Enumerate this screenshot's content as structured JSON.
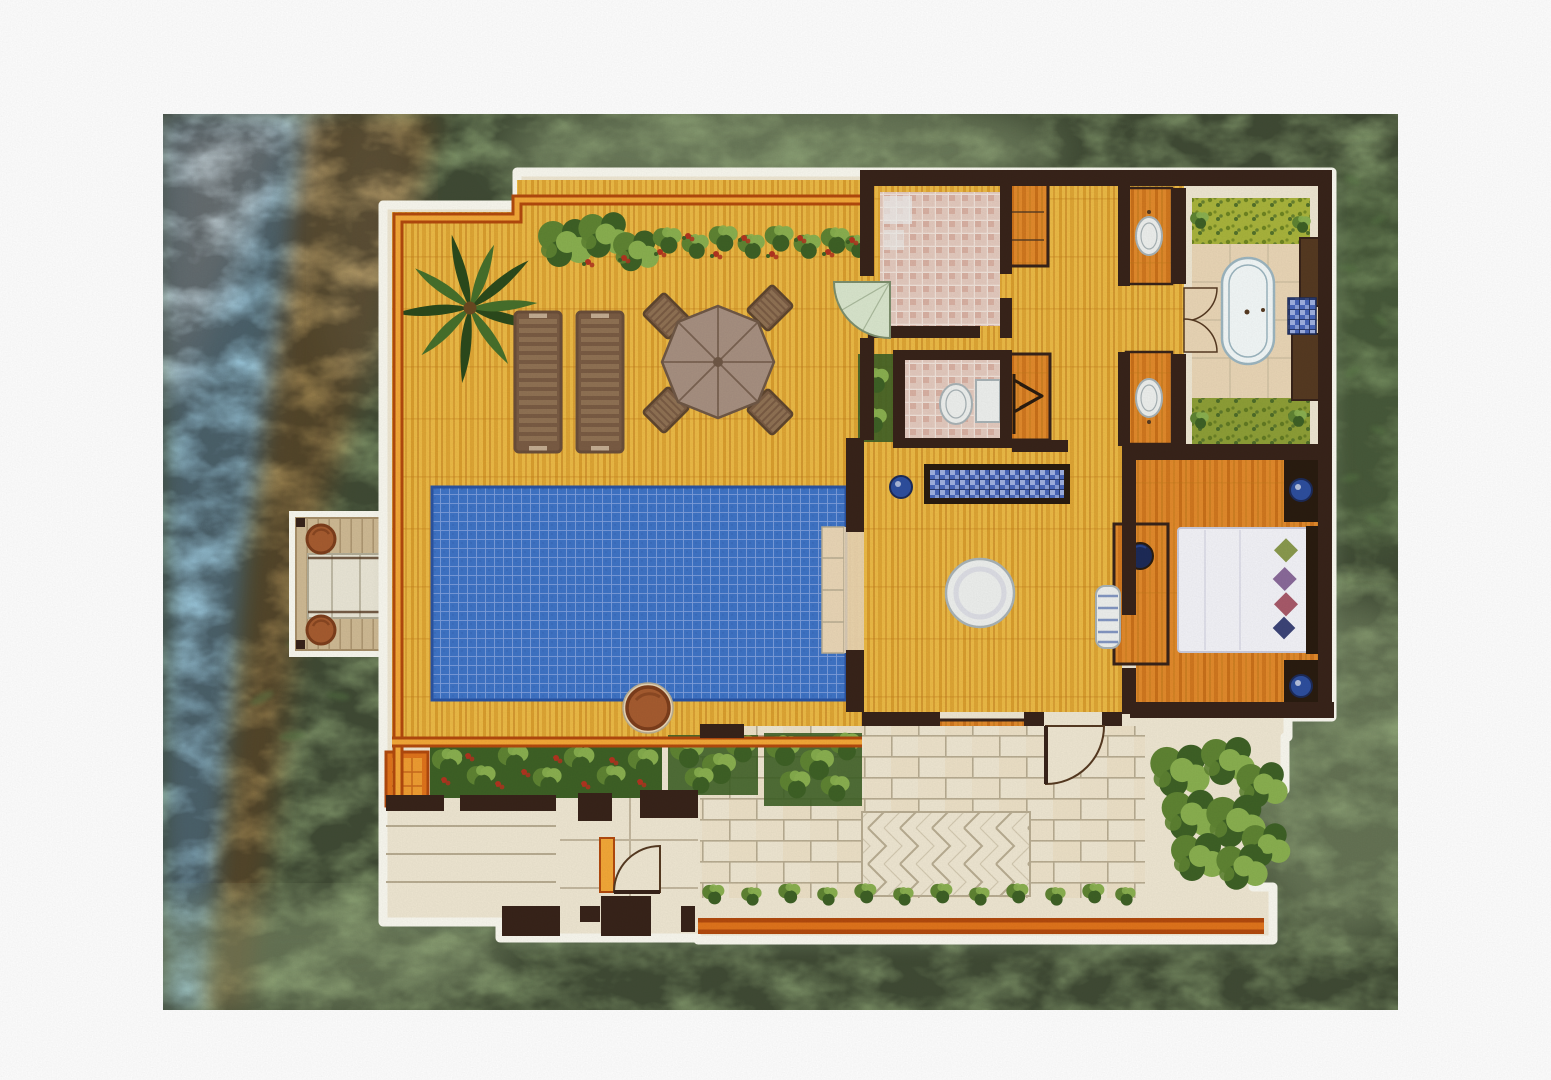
{
  "palette": {
    "paper": "#ffffff",
    "lawn": "#90a877",
    "lawnDark": "#74905c",
    "lawnLight": "#aabf90",
    "foliage": "#5a7a46",
    "water": "#a8d8ee",
    "waterLight": "#e6f4fa",
    "sand": "#c29a5a",
    "sandLight": "#dcc38e",
    "outline": "#f9f8ef",
    "shadow": "#76886a",
    "wall": "#38241a",
    "wallSoft": "#563a22",
    "deckBase": "#ecba46",
    "deckStripe": "#d7992a",
    "deckShade": "#c07a1c",
    "deckOBase": "#e28a2c",
    "deckOStripe": "#c66c16",
    "trimDark": "#b24a0e",
    "trimMid": "#e0741c",
    "trimLight": "#f3a838",
    "pool": "#3f74c6",
    "poolGrid": "#88a6e0",
    "poolDark": "#2b54a2",
    "stone": "#efe7d2",
    "stoneLine": "#b9ad92",
    "stoneWarm": "#ead6b6",
    "mosaic": "#e4cabe",
    "mosaicLine": "#f1e3da",
    "mosaicAccent": "#cf9d8c",
    "hedgeDark": "#3e6126",
    "hedge": "#5f8433",
    "hedgeLight": "#8ab050",
    "flower": "#b23420",
    "lime": "#a9b43c",
    "limeDark": "#6f8522",
    "palmDark": "#2c4a1c",
    "palm": "#47702c",
    "trunk": "#6b4a22",
    "loungerBase": "#7a5c44",
    "loungerFrame": "#6b4f3a",
    "loungerSlat": "#907254",
    "loungerLight": "#c4ad92",
    "parasol": "#a79081",
    "parasolLine": "#6f5846",
    "chairFrame": "#5f462f",
    "furnWhite": "#eef0ee",
    "furnLine": "#a9b3b6",
    "tub": "#f3f8f8",
    "tubLine": "#9db6c0",
    "lampBlue": "#2e4f9e",
    "lampDark": "#1d2b58",
    "blueTile": "#4a67ba",
    "blueTileLight": "#9fb0e0",
    "bedWhite": "#f3f3f8",
    "bedLine": "#ccccdc",
    "pillowOlive": "#8a9a4e",
    "pillowPurple": "#8a6a9a",
    "pillowRose": "#a85a6a",
    "pillowNavy": "#3c4478",
    "headboard": "#2a1c10",
    "pot": "#a65c30",
    "potDark": "#7d3e1c",
    "jetty": "#cfba94",
    "jettyLine": "#a8906a",
    "mat": "#eae6d6",
    "matLine": "#b2ac96",
    "glass": "#d9e6cd",
    "glassLine": "#7d8f6d",
    "bowl": "#6b6654",
    "scan": "#141408"
  },
  "features": [
    "ocean-water",
    "beach-sand",
    "lawn",
    "jetty-platform",
    "jetty-pouf",
    "jetty-mat",
    "sun-deck",
    "deck-border-trim",
    "palm-tree",
    "deck-hedge",
    "sun-lounger",
    "parasol-dining-set",
    "swimming-pool",
    "pool-steps",
    "outdoor-shower-court",
    "glass-entry-door",
    "storage-cabinet",
    "wardrobe-hanger",
    "vanity-sink",
    "bathroom-double-doors",
    "outdoor-bath-courtyard",
    "bathtub",
    "garden-strip",
    "toilet-room",
    "living-room",
    "blue-check-console",
    "flower-pot",
    "round-dining-table",
    "tv-console",
    "stone-shelf",
    "bedroom",
    "double-bed",
    "decor-pillows",
    "nightstand-lamp",
    "bedside-bench",
    "entry-gate",
    "stone-path",
    "herringbone-path",
    "garden-beds",
    "terracotta-pot",
    "boundary-wall",
    "rear-garden"
  ]
}
